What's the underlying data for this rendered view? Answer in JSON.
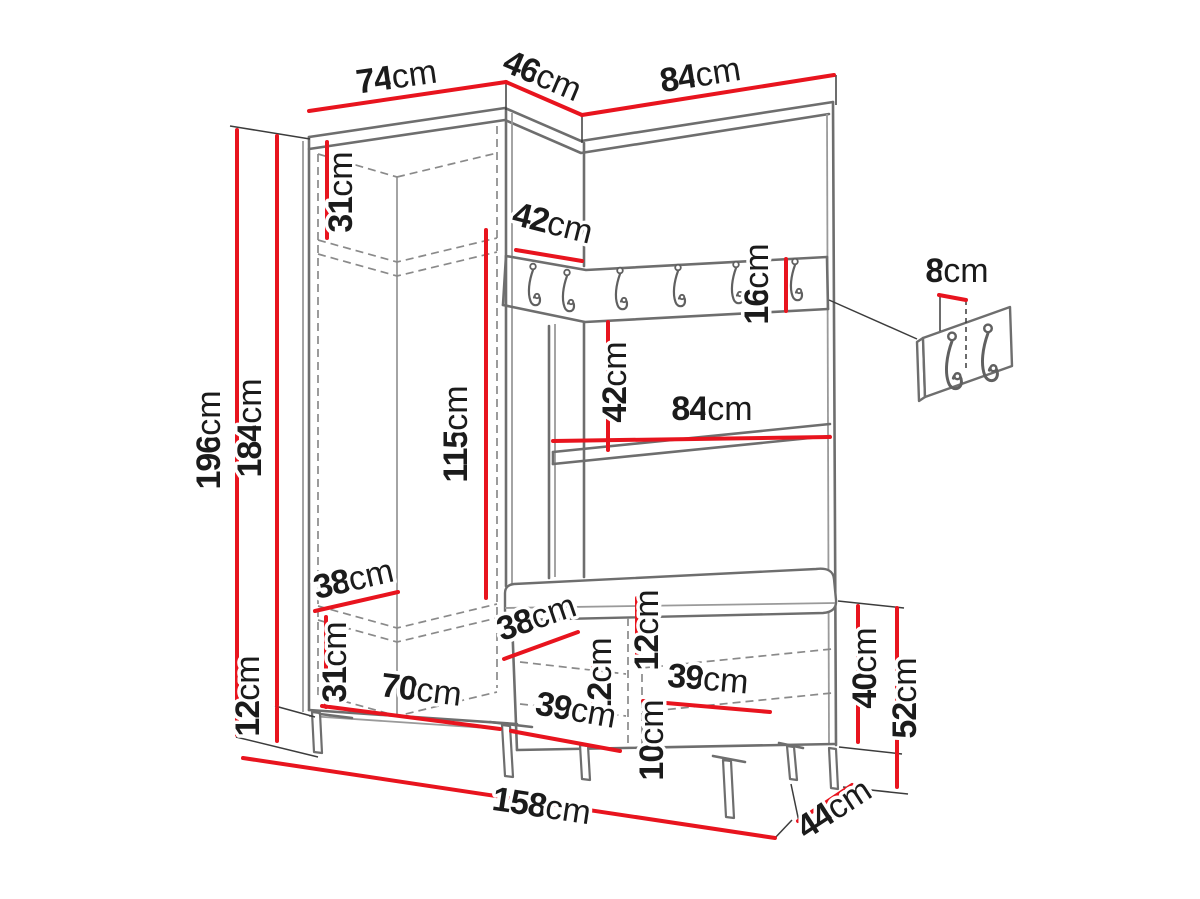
{
  "diagram": {
    "type": "furniture-dimension-drawing",
    "unit": "cm"
  },
  "dimensions": {
    "top_width_left": {
      "value": "74",
      "unit": "cm"
    },
    "top_width_corner": {
      "value": "46",
      "unit": "cm"
    },
    "top_width_right": {
      "value": "84",
      "unit": "cm"
    },
    "upper_shelf_space_height": {
      "value": "31",
      "unit": "cm"
    },
    "total_height": {
      "value": "196",
      "unit": "cm"
    },
    "cabinet_height": {
      "value": "184",
      "unit": "cm"
    },
    "hanging_space_height": {
      "value": "115",
      "unit": "cm"
    },
    "corner_panel_width": {
      "value": "42",
      "unit": "cm"
    },
    "hook_rail_height": {
      "value": "16",
      "unit": "cm"
    },
    "space_below_rail": {
      "value": "42",
      "unit": "cm"
    },
    "shelf_width": {
      "value": "84",
      "unit": "cm"
    },
    "hook_spacing": {
      "value": "8",
      "unit": "cm"
    },
    "wardrobe_shelf_depth": {
      "value": "38",
      "unit": "cm"
    },
    "lower_compartment_height": {
      "value": "31",
      "unit": "cm"
    },
    "leg_height": {
      "value": "12",
      "unit": "cm"
    },
    "wardrobe_interior_width": {
      "value": "70",
      "unit": "cm"
    },
    "bench_seat_depth": {
      "value": "38",
      "unit": "cm"
    },
    "bench_seat_thickness": {
      "value": "12",
      "unit": "cm"
    },
    "bench_shelf_spacing": {
      "value": "12",
      "unit": "cm"
    },
    "bench_right_compartment": {
      "value": "39",
      "unit": "cm"
    },
    "bench_lower_gap": {
      "value": "10",
      "unit": "cm"
    },
    "bench_left_compartment": {
      "value": "39",
      "unit": "cm"
    },
    "bench_cabinet_height": {
      "value": "40",
      "unit": "cm"
    },
    "bench_total_height": {
      "value": "52",
      "unit": "cm"
    },
    "bench_depth": {
      "value": "44",
      "unit": "cm"
    },
    "total_width": {
      "value": "158",
      "unit": "cm"
    }
  },
  "colors": {
    "dimension_line": "#e8141e",
    "furniture_line": "#6e6e6e",
    "text": "#1b1b1b",
    "background": "#ffffff"
  }
}
